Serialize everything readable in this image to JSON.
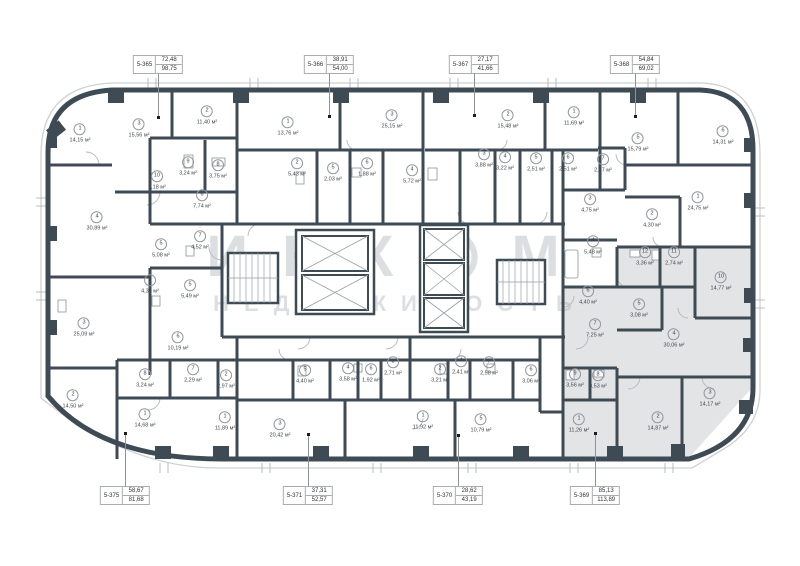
{
  "watermark": {
    "brand_part1": "ИНК",
    "brand_part2": "М",
    "tagline": "НЕДВИЖИМОСТЬ"
  },
  "area_unit": "м²",
  "highlighted_apartment": "5-369",
  "callouts": {
    "top": [
      {
        "id": "5-365",
        "area1": "72,48",
        "area2": "98,75",
        "x": 158,
        "dot_y": 117
      },
      {
        "id": "5-366",
        "area1": "38,91",
        "area2": "54,00",
        "x": 329,
        "dot_y": 116
      },
      {
        "id": "5-367",
        "area1": "27,17",
        "area2": "41,66",
        "x": 474,
        "dot_y": 115
      },
      {
        "id": "5-368",
        "area1": "54,84",
        "area2": "69,02",
        "x": 635,
        "dot_y": 116
      }
    ],
    "bottom": [
      {
        "id": "5-375",
        "area1": "58,67",
        "area2": "81,68",
        "x": 125,
        "dot_y": 433
      },
      {
        "id": "5-371",
        "area1": "37,31",
        "area2": "52,57",
        "x": 308,
        "dot_y": 434
      },
      {
        "id": "5-370",
        "area1": "28,62",
        "area2": "43,19",
        "x": 458,
        "dot_y": 435
      },
      {
        "id": "5-369",
        "area1": "85,13",
        "area2": "113,89",
        "x": 595,
        "dot_y": 433
      }
    ]
  },
  "rooms": [
    {
      "apt": "5-365",
      "n": "1",
      "area": "14,15",
      "x": 80,
      "y": 133,
      "hl": false
    },
    {
      "apt": "5-365",
      "n": "3",
      "area": "15,56",
      "x": 139,
      "y": 128,
      "hl": false
    },
    {
      "apt": "5-365",
      "n": "2",
      "area": "11,40",
      "x": 207,
      "y": 115,
      "hl": false
    },
    {
      "apt": "5-365",
      "n": "9",
      "area": "3,24",
      "x": 188,
      "y": 166,
      "hl": false
    },
    {
      "apt": "5-365",
      "n": "8",
      "area": "3,75",
      "x": 218,
      "y": 169,
      "hl": false
    },
    {
      "apt": "5-365",
      "n": "10",
      "area": "1,18",
      "x": 157,
      "y": 180,
      "hl": false
    },
    {
      "apt": "5-365",
      "n": "6",
      "area": "7,74",
      "x": 202,
      "y": 199,
      "hl": false
    },
    {
      "apt": "5-365",
      "n": "4",
      "area": "30,89",
      "x": 97,
      "y": 221,
      "hl": false
    },
    {
      "apt": "5-365",
      "n": "7",
      "area": "4,52",
      "x": 200,
      "y": 240,
      "hl": false
    },
    {
      "apt": "5-365",
      "n": "5",
      "area": "5,08",
      "x": 161,
      "y": 248,
      "hl": false
    },
    {
      "apt": "5-366",
      "n": "1",
      "area": "13,76",
      "x": 288,
      "y": 126,
      "hl": false
    },
    {
      "apt": "5-366",
      "n": "3",
      "area": "25,15",
      "x": 392,
      "y": 119,
      "hl": false
    },
    {
      "apt": "5-366",
      "n": "2",
      "area": "5,43",
      "x": 297,
      "y": 167,
      "hl": false
    },
    {
      "apt": "5-366",
      "n": "5",
      "area": "2,03",
      "x": 333,
      "y": 172,
      "hl": false
    },
    {
      "apt": "5-366",
      "n": "6",
      "area": "1,88",
      "x": 367,
      "y": 167,
      "hl": false
    },
    {
      "apt": "5-366",
      "n": "4",
      "area": "5,72",
      "x": 412,
      "y": 174,
      "hl": false
    },
    {
      "apt": "5-367",
      "n": "2",
      "area": "15,48",
      "x": 508,
      "y": 119,
      "hl": false
    },
    {
      "apt": "5-367",
      "n": "1",
      "area": "11,69",
      "x": 574,
      "y": 116,
      "hl": false
    },
    {
      "apt": "5-367",
      "n": "3",
      "area": "3,88",
      "x": 484,
      "y": 158,
      "hl": false
    },
    {
      "apt": "5-367",
      "n": "4",
      "area": "3,22",
      "x": 505,
      "y": 161,
      "hl": false
    },
    {
      "apt": "5-367",
      "n": "5",
      "area": "2,51",
      "x": 536,
      "y": 162,
      "hl": false
    },
    {
      "apt": "5-367",
      "n": "6",
      "area": "2,51",
      "x": 568,
      "y": 162,
      "hl": false
    },
    {
      "apt": "5-367",
      "n": "7",
      "area": "2,37",
      "x": 603,
      "y": 163,
      "hl": false
    },
    {
      "apt": "5-368",
      "n": "5",
      "area": "15,79",
      "x": 638,
      "y": 142,
      "hl": false
    },
    {
      "apt": "5-368",
      "n": "6",
      "area": "14,31",
      "x": 723,
      "y": 135,
      "hl": false
    },
    {
      "apt": "5-368",
      "n": "1",
      "area": "24,75",
      "x": 698,
      "y": 201,
      "hl": false
    },
    {
      "apt": "5-368",
      "n": "2",
      "area": "4,30",
      "x": 652,
      "y": 218,
      "hl": false
    },
    {
      "apt": "5-368",
      "n": "3",
      "area": "4,75",
      "x": 590,
      "y": 203,
      "hl": false
    },
    {
      "apt": "5-368",
      "n": "4",
      "area": "5,48",
      "x": 593,
      "y": 245,
      "hl": false
    },
    {
      "apt": "5-375",
      "n": "4",
      "area": "4,30",
      "x": 150,
      "y": 284,
      "hl": false
    },
    {
      "apt": "5-375",
      "n": "5",
      "area": "5,49",
      "x": 190,
      "y": 289,
      "hl": false
    },
    {
      "apt": "5-375",
      "n": "3",
      "area": "25,09",
      "x": 84,
      "y": 327,
      "hl": false
    },
    {
      "apt": "5-375",
      "n": "6",
      "area": "10,19",
      "x": 178,
      "y": 341,
      "hl": false
    },
    {
      "apt": "5-375",
      "n": "2",
      "area": "14,50",
      "x": 73,
      "y": 399,
      "hl": false
    },
    {
      "apt": "5-375",
      "n": "8",
      "area": "3,24",
      "x": 145,
      "y": 378,
      "hl": false
    },
    {
      "apt": "5-375",
      "n": "7",
      "area": "2,29",
      "x": 193,
      "y": 373,
      "hl": false
    },
    {
      "apt": "5-375",
      "n": "1",
      "area": "14,68",
      "x": 145,
      "y": 418,
      "hl": false
    },
    {
      "apt": "5-371",
      "n": "2",
      "area": "2,97",
      "x": 226,
      "y": 379,
      "hl": false
    },
    {
      "apt": "5-371",
      "n": "5",
      "area": "4,40",
      "x": 305,
      "y": 374,
      "hl": false
    },
    {
      "apt": "5-371",
      "n": "4",
      "area": "3,58",
      "x": 348,
      "y": 372,
      "hl": false
    },
    {
      "apt": "5-371",
      "n": "6",
      "area": "1,92",
      "x": 371,
      "y": 373,
      "hl": false
    },
    {
      "apt": "5-371",
      "n": "1",
      "area": "11,89",
      "x": 225,
      "y": 421,
      "hl": false
    },
    {
      "apt": "5-371",
      "n": "3",
      "area": "20,42",
      "x": 280,
      "y": 428,
      "hl": false
    },
    {
      "apt": "5-370",
      "n": "3",
      "area": "2,71",
      "x": 393,
      "y": 366,
      "hl": false
    },
    {
      "apt": "5-370",
      "n": "2",
      "area": "3,21",
      "x": 440,
      "y": 373,
      "hl": false
    },
    {
      "apt": "5-370",
      "n": "4",
      "area": "2,41",
      "x": 461,
      "y": 365,
      "hl": false
    },
    {
      "apt": "5-370",
      "n": "7",
      "area": "2,58",
      "x": 489,
      "y": 366,
      "hl": false
    },
    {
      "apt": "5-370",
      "n": "6",
      "area": "3,06",
      "x": 531,
      "y": 374,
      "hl": false
    },
    {
      "apt": "5-370",
      "n": "1",
      "area": "11,92",
      "x": 423,
      "y": 420,
      "hl": false
    },
    {
      "apt": "5-370",
      "n": "5",
      "area": "10,79",
      "x": 481,
      "y": 423,
      "hl": false
    },
    {
      "apt": "5-369",
      "n": "12",
      "area": "3,36",
      "x": 645,
      "y": 256,
      "hl": true
    },
    {
      "apt": "5-369",
      "n": "11",
      "area": "2,74",
      "x": 674,
      "y": 256,
      "hl": true
    },
    {
      "apt": "5-369",
      "n": "10",
      "area": "14,77",
      "x": 721,
      "y": 281,
      "hl": true
    },
    {
      "apt": "5-369",
      "n": "5",
      "area": "3,08",
      "x": 639,
      "y": 308,
      "hl": true
    },
    {
      "apt": "5-369",
      "n": "6",
      "area": "4,40",
      "x": 588,
      "y": 295,
      "hl": true
    },
    {
      "apt": "5-369",
      "n": "7",
      "area": "7,25",
      "x": 595,
      "y": 328,
      "hl": true
    },
    {
      "apt": "5-369",
      "n": "4",
      "area": "30,06",
      "x": 674,
      "y": 338,
      "hl": true
    },
    {
      "apt": "5-369",
      "n": "9",
      "area": "3,56",
      "x": 575,
      "y": 378,
      "hl": true
    },
    {
      "apt": "5-369",
      "n": "8",
      "area": "3,53",
      "x": 598,
      "y": 379,
      "hl": true
    },
    {
      "apt": "5-369",
      "n": "1",
      "area": "11,26",
      "x": 579,
      "y": 423,
      "hl": true
    },
    {
      "apt": "5-369",
      "n": "2",
      "area": "14,87",
      "x": 658,
      "y": 421,
      "hl": true
    },
    {
      "apt": "5-369",
      "n": "3",
      "area": "14,17",
      "x": 710,
      "y": 397,
      "hl": true
    }
  ]
}
